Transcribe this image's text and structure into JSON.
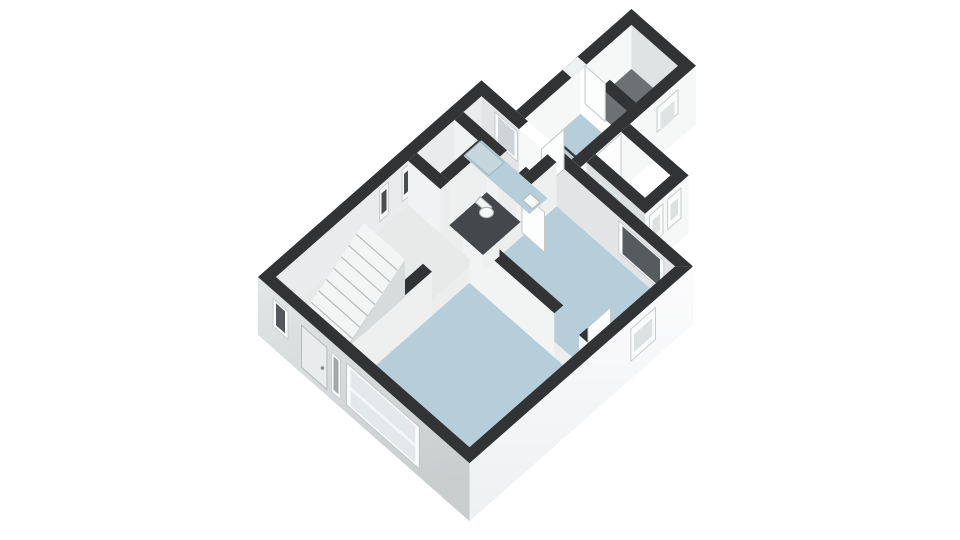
{
  "scene": {
    "description": "3D isometric cutaway floor plan of a dwelling on a white background",
    "view": "isometric-top",
    "background": "#ffffff",
    "width": 960,
    "height": 540
  },
  "palette": {
    "wall_top_band": "#313335",
    "wall_exterior_white": "#f6f7f7",
    "wall_exterior_gray_top": "#e3e6e7",
    "wall_exterior_gray_bottom": "#c9cdce",
    "wall_interior_light": "#f6f7f7",
    "wall_interior_shaded": "#e2e4e5",
    "floor_blue": "#b5ced9",
    "floor_light": "#e8eaea",
    "floor_storage_gray": "#6e7173",
    "floor_wc_dark": "#44484a",
    "glass_dark": "#565b5d",
    "glass_light": "#dde1e2",
    "fixture_white": "#f6f7f7"
  },
  "rooms": [
    {
      "id": "hall",
      "label": "hall with staircase",
      "floor": "light",
      "features": [
        "staircase-8-treads",
        "front-door",
        "two-narrow-nw-windows",
        "corner-window"
      ]
    },
    {
      "id": "living-room",
      "label": "living room",
      "floor": "blue",
      "features": [
        "large-front-window"
      ]
    },
    {
      "id": "bedroom",
      "label": "bedroom",
      "floor": "blue",
      "features": [
        "ne-window",
        "se-window",
        "open-door"
      ]
    },
    {
      "id": "wc",
      "label": "wc",
      "floor": "dark",
      "features": [
        "toilet"
      ]
    },
    {
      "id": "bathroom",
      "label": "bathroom",
      "floor": "blue",
      "features": [
        "shower-tray",
        "washbasin",
        "window",
        "door-to-kitchen"
      ]
    },
    {
      "id": "kitchen",
      "label": "kitchen / rear room",
      "floor": "blue",
      "features": [
        "skylight-outline",
        "side-door"
      ]
    },
    {
      "id": "storage",
      "label": "storage room",
      "floor": "gray",
      "features": [
        "se-window",
        "nw-window-notch",
        "door-to-kitchen"
      ]
    },
    {
      "id": "annex",
      "label": "side annex / porch",
      "floor": "light",
      "features": [
        "two-se-windows",
        "glass-panel"
      ]
    }
  ],
  "shapes": [
    {
      "n": "ext-nw-wall-band",
      "f": "#313335",
      "p": "516,110.7 631.5,9 640.5,17 525,118.6"
    },
    {
      "n": "storage-nw-window-notch",
      "f": "#eef1f1",
      "p": "562.5,69.8 577.5,56.6 586.5,64.5 571.5,77.7"
    },
    {
      "n": "storage-nw-inner-wall",
      "f": "#f6f7f7",
      "p": "589.5,61.8 631.5,24.9 631.5,68.9 589.5,105.8"
    },
    {
      "n": "storage-ne-inner-wall",
      "f": "#e0e3e4",
      "p": "631.5,24.9 678,65.8 678,109.8 631.5,68.9"
    },
    {
      "n": "storage-floor",
      "f": "#6e7173",
      "p": "589.5,105.8 631.5,68.9 678,109.8 636,146.8"
    },
    {
      "n": "kitchen-nw-inner-wall",
      "f": "#f6f7f7",
      "p": "525,118.6 580.5,69.8 580.5,113.8 525,162.6"
    },
    {
      "n": "kitchen-floor",
      "f": "#b5ced9",
      "p": "525,162.6 580.5,113.8 627,154.7 571.5,203.5"
    },
    {
      "n": "kitchen-skylight-outline",
      "f": "none",
      "s": "#3b3d3e",
      "w": 2.5,
      "p": "529.5,163.9 556.5,140.2 585,165.2 558,189"
    },
    {
      "n": "kitchen-storage-partition-band",
      "f": "#313335",
      "p": "600.8,87.6 627,110.7 636,102.8 609.8,79.7"
    },
    {
      "n": "storage-door-leaf",
      "f": "#fcfdfd",
      "s": "#c5c9ca",
      "w": 1,
      "p": "585,65.8 605.3,83.6 605.3,121.6 585,103.8"
    },
    {
      "n": "ext-ne-wall-band",
      "f": "#313335",
      "p": "631.5,9 696,65.8 687,73.7 622.5,17"
    },
    {
      "n": "ext-se-wall-band",
      "f": "#313335",
      "p": "580.5,167.4 696,65.8 678,65.8 571.5,159.5"
    },
    {
      "n": "ext-se-wall-face",
      "f": "#f6f7f7",
      "p": "580.5,167.4 696,65.8 696,123.8 580.5,225.4"
    },
    {
      "n": "storage-se-window-frame",
      "f": "#fafbfb",
      "s": "#c9cdce",
      "w": 1,
      "p": "657,108.1 678,89.6 678,113.6 657,132.1"
    },
    {
      "n": "storage-se-window-glass",
      "f": "#dfe3e4",
      "p": "660.5,112.9 674.5,100.6 674.5,118.1 660.5,130.4"
    },
    {
      "n": "kitchen-se-door",
      "f": "#fdfdfd",
      "s": "#c5c9ca",
      "w": 1,
      "p": "595.5,156.2 621,133.8 621,177.8 595.5,200.2"
    },
    {
      "n": "annex-floor",
      "f": "#eef0f0",
      "p": "604.5,206.2 630,183.7 670.5,219.4 645,241.8"
    },
    {
      "n": "annex-sw-wall-face",
      "f": "#dcdfe0",
      "p": "586.5,162.2 645,213.6 645,271.6 586.5,220.2"
    },
    {
      "n": "annex-sw-glass-panel",
      "f": "#c8d7dd",
      "s": "#eef1f2",
      "w": 1,
      "p": "600,182 618.8,198.5 618.8,238.5 600,222"
    },
    {
      "n": "annex-se-wall-face",
      "f": "#f6f7f7",
      "p": "645,213.6 688.5,175.4 688.5,233.4 645,271.6"
    },
    {
      "n": "annex-window-1-frame",
      "f": "#fafbfb",
      "s": "#c9cdce",
      "w": 1,
      "p": "649.5,215.7 663,203.8 663,233.8 649.5,245.7"
    },
    {
      "n": "annex-window-1-glass",
      "f": "#dde1e2",
      "p": "652.5,220.4 660,213.8 660,230.3 652.5,236.9"
    },
    {
      "n": "annex-window-2-frame",
      "f": "#fafbfb",
      "s": "#c9cdce",
      "w": 1,
      "p": "667.5,199.8 681,188 681,218 667.5,229.8"
    },
    {
      "n": "annex-window-2-glass",
      "f": "#dde1e2",
      "p": "670.5,204.5 678,197.9 678,214.4 670.5,221"
    },
    {
      "n": "annex-sw-wall-band",
      "f": "#313335",
      "p": "586.5,162.2 645,213.6 654,205.7 595.5,154.2"
    },
    {
      "n": "annex-ne-wall-band",
      "f": "#313335",
      "p": "630,123.9 688.5,175.4 679.5,183.3 621,131.8"
    },
    {
      "n": "annex-se-wall-band",
      "f": "#313335",
      "p": "645,213.6 688.5,175.4 679.5,167.4 636,205.7"
    },
    {
      "n": "main-ne-exterior-mask",
      "f": "#ffffff",
      "p": "481.5,80.3 693,266.4 693,324.4 481.5,138.3"
    },
    {
      "n": "main-nw-wall-band",
      "f": "#313335",
      "p": "258,277 481.5,80.3 481.5,96.2 276,277"
    },
    {
      "n": "main-ne-wall-band-a",
      "f": "#313335",
      "p": "481.5,80.3 528,121.2 519,129.2 481.5,96.2"
    },
    {
      "n": "main-ne-wall-band-b",
      "f": "#313335",
      "p": "550.5,141 693,266.4 675,266.4 541.5,149"
    },
    {
      "n": "interior-base-floor",
      "f": "#eceeee",
      "p": "276,321 481.5,140.2 675,310.4 469.5,491.3"
    },
    {
      "n": "main-nw-inner-wall",
      "f": "#e9ebec",
      "p": "276,277 481.5,96.2 481.5,140.2 276,321"
    },
    {
      "n": "nw-slit-window-1-frame",
      "f": "#f5f6f6",
      "s": "#c9cdce",
      "w": 1,
      "p": "379.5,189.9 388.5,182 388.5,214 379.5,221.9"
    },
    {
      "n": "nw-slit-window-1-glass",
      "f": "#4a4d4f",
      "p": "381.5,193.4 386.5,189 386.5,210 381.5,214.4"
    },
    {
      "n": "nw-slit-window-2-frame",
      "f": "#f5f6f6",
      "s": "#c9cdce",
      "w": 1,
      "p": "402,170.1 411,162.2 411,194.2 402,202.1"
    },
    {
      "n": "nw-slit-window-2-glass",
      "f": "#4a4d4f",
      "p": "404,173.9 409,169.5 409,190.5 404,194.9"
    },
    {
      "n": "main-ne-inner-wall",
      "f": "#e2e4e5",
      "p": "481.5,96.2 675,266.4 675,310.4 481.5,140.2"
    },
    {
      "n": "bathroom-window-frame",
      "f": "#fafbfb",
      "s": "#c9cdce",
      "w": 1,
      "p": "495,112 517.5,131.8 517.5,161.8 495,142"
    },
    {
      "n": "bathroom-window-glass",
      "f": "#cfd5d7",
      "p": "498,116.9 514.5,131.4 514.5,156.4 498,141.9"
    },
    {
      "n": "kitchen-doorway-opening",
      "f": "#f7f9f9",
      "p": "519,129.2 541.5,149 541.5,193 519,173.2"
    },
    {
      "n": "kitchen-door-leaf",
      "f": "#fcfdfd",
      "s": "#c5c9ca",
      "w": 1,
      "p": "541.5,149 564,129.2 564,169.2 541.5,189"
    },
    {
      "n": "bedroom-ne-window-frame",
      "f": "#fafbfb",
      "s": "#c9cdce",
      "w": 1,
      "p": "618.8,220.9 663.8,260.5 663.8,292.5 618.8,252.9"
    },
    {
      "n": "bedroom-ne-window-glass",
      "f": "#565b5d",
      "p": "622.5,226.3 660,259.3 660,286.9 622.5,253.9"
    },
    {
      "n": "hall-floor",
      "f": "#e8eaea",
      "p": "276,321 408,204.8 474,262.9 342,379.1"
    },
    {
      "n": "living-room-floor",
      "f": "#b5ced9",
      "p": "351,387 469.5,282.7 588,387 469.5,491.3"
    },
    {
      "n": "bedroom-floor",
      "f": "#b5ced9",
      "p": "478.5,274.8 556.5,206.2 675,310.4 597,379.1"
    },
    {
      "n": "hall-living-wall-band",
      "f": "#313335",
      "p": "342,335.1 423,263.8 432,271.7 351,343"
    },
    {
      "n": "hall-living-wall-face",
      "f": "#eef0f0",
      "p": "351,343 432,271.7 432,315.7 351,387"
    },
    {
      "n": "living-bedroom-wall-band-a",
      "f": "#313335",
      "p": "469.5,238.7 554.3,313.3 563.3,305.4 478.5,230.8"
    },
    {
      "n": "living-bedroom-wall-band-b",
      "f": "#313335",
      "p": "579,335.1 588,343 597,335.1 588,327.2"
    },
    {
      "n": "living-bedroom-wall-face-a",
      "f": "#f2f3f3",
      "p": "469.5,238.7 554.3,313.3 554.3,357.3 469.5,282.7"
    },
    {
      "n": "living-bedroom-wall-face-b",
      "f": "#f2f3f3",
      "p": "579,335.1 588,343 588,387 579,379.1"
    },
    {
      "n": "bedroom-door-leaf",
      "f": "#fcfdfd",
      "s": "#c5c9ca",
      "w": 1,
      "p": "588,327.2 610.5,307.4 610.5,347.4 588,367.2"
    },
    {
      "n": "hall-backrooms-wall-band-a",
      "f": "#313335",
      "p": "408,160.8 440.3,189.2 449.3,181.3 417,152.9"
    },
    {
      "n": "hall-backrooms-wall-band-b",
      "f": "#313335",
      "p": "462.8,209 474,218.9 483,211 471.8,201.1"
    },
    {
      "n": "hall-backrooms-wall-face-a",
      "f": "#f1f2f3",
      "p": "408,160.8 440.3,189.2 440.3,233.2 408,204.8"
    },
    {
      "n": "hall-backrooms-wall-face-b",
      "f": "#f1f2f3",
      "p": "462.8,209 474,218.9 474,262.9 462.8,253"
    },
    {
      "n": "wc-bathroom-wall-band-a",
      "f": "#313335",
      "p": "454.5,119.9 498,158.2 507,150.3 463.5,112"
    },
    {
      "n": "wc-bathroom-wall-band-b",
      "f": "#313335",
      "p": "516.8,174.7 520.5,178 529.5,170.1 525.8,166.8"
    },
    {
      "n": "wc-bathroom-wall-face-a",
      "f": "#f1f2f3",
      "p": "454.5,119.9 498,158.2 498,202.2 454.5,163.9"
    },
    {
      "n": "wc-bathroom-wall-face-b",
      "f": "#f1f2f3",
      "p": "516.8,174.7 520.5,178 520.5,222 516.8,218.7"
    },
    {
      "n": "wc-nw-wall-band",
      "f": "#313335",
      "p": "440.3,173.4 477.8,140.4 486.8,148.3 449.3,181.3"
    },
    {
      "n": "wc-nw-wall-face",
      "f": "#eef0f0",
      "p": "449.3,181.3 486.8,148.3 486.8,192.3 449.3,225.3"
    },
    {
      "n": "corridor-bedroom-wall-band-a",
      "f": "#313335",
      "p": "474,218.9 490.5,204.4 499.5,212.3 483,226.8"
    },
    {
      "n": "corridor-bedroom-wall-band-b",
      "f": "#313335",
      "p": "513,184.6 547.5,154.3 556.5,162.2 522,192.5"
    },
    {
      "n": "corridor-bedroom-wall-face-a",
      "f": "#eef0f0",
      "p": "483,226.8 499.5,212.3 499.5,256.3 483,270.8"
    },
    {
      "n": "corridor-bedroom-wall-face-b",
      "f": "#eef0f0",
      "p": "522,192.5 556.5,162.2 556.5,206.2 522,236.5"
    },
    {
      "n": "corridor-door-leaf",
      "f": "#fcfdfd",
      "s": "#c5c9ca",
      "w": 1,
      "p": "522,192.5 544.5,212.3 544.5,252.3 522,232.5"
    },
    {
      "n": "wc-floor",
      "f": "#44484a",
      "p": "449.3,225.3 486.8,192.3 520.5,222 483,255"
    },
    {
      "n": "toilet-tank",
      "f": "#f4f5f5",
      "s": "#a8adae",
      "w": 1,
      "p": "480,196.5 492,207 487.5,213 475.5,202.5"
    },
    {
      "n": "toilet-bowl",
      "t": "ellipse",
      "f": "#f7f8f8",
      "s": "#a8adae",
      "w": 1,
      "cx": 486.5,
      "cy": 212.5,
      "rx": 7,
      "ry": 5.2
    },
    {
      "n": "bathroom-floor",
      "f": "#b5ced9",
      "p": "463.5,156 481.5,140.2 547.5,198.3 529.5,214.1"
    },
    {
      "n": "shower-tray",
      "f": "#c5d6dd",
      "s": "#9fb3bb",
      "w": 1,
      "p": "465,154.7 480,141.5 504,162.6 489,175.8"
    },
    {
      "n": "washbasin",
      "f": "#f6f7f7",
      "s": "#b5babb",
      "w": 1,
      "p": "522.8,200.2 530.3,193.6 540,202.2 532.5,208.8"
    },
    {
      "n": "staircase-ramp",
      "f": "#f3f4f4",
      "p": "303.8,313.7 345,350 405,259.2 363.8,222.9"
    },
    {
      "n": "staircase-stringer",
      "f": "#d8dbdc",
      "p": "345,350 405,259.2 405,297.2"
    },
    {
      "n": "stair-tread-1",
      "t": "polyline",
      "f": "none",
      "s": "#b9bdbe",
      "w": 1.2,
      "p": "311.3,302.4 352.5,338.7"
    },
    {
      "n": "stair-tread-2",
      "t": "polyline",
      "f": "none",
      "s": "#b9bdbe",
      "w": 1.2,
      "p": "318.8,291.0 360,327.3"
    },
    {
      "n": "stair-tread-3",
      "t": "polyline",
      "f": "none",
      "s": "#b9bdbe",
      "w": 1.2,
      "p": "326.3,279.6 367.5,316.0"
    },
    {
      "n": "stair-tread-4",
      "t": "polyline",
      "f": "none",
      "s": "#b9bdbe",
      "w": 1.2,
      "p": "333.8,268.3 375,304.6"
    },
    {
      "n": "stair-tread-5",
      "t": "polyline",
      "f": "none",
      "s": "#b9bdbe",
      "w": 1.2,
      "p": "341.3,256.9 382.5,293.2"
    },
    {
      "n": "stair-tread-6",
      "t": "polyline",
      "f": "none",
      "s": "#b9bdbe",
      "w": 1.2,
      "p": "348.8,245.6 390,281.9"
    },
    {
      "n": "stair-tread-7",
      "t": "polyline",
      "f": "none",
      "s": "#b9bdbe",
      "w": 1.2,
      "p": "356.3,234.2 397.5,270.5"
    },
    {
      "n": "main-sw-wall-face",
      "f": "url(#gswall)",
      "p": "258,277 469.5,463.1 469.5,521.1 258,335"
    },
    {
      "n": "main-se-wall-face",
      "f": "url(#gsewall)",
      "p": "469.5,463.1 693,266.4 693,324.4 469.5,521.1"
    },
    {
      "n": "main-sw-wall-band",
      "f": "#313335",
      "p": "469.5,463.1 258,277 276,277 469.5,447.3"
    },
    {
      "n": "main-se-wall-band",
      "f": "#313335",
      "p": "693,266.4 469.5,463.1 469.5,447.3 675,266.4"
    },
    {
      "n": "front-door",
      "f": "#e9ebec",
      "s": "#b5babb",
      "w": 1,
      "p": "301.5,325.3 327,347.7 327,389.7 301.5,367.3"
    },
    {
      "n": "front-door-handle",
      "t": "ellipse",
      "f": "#84898b",
      "cx": 322.5,
      "cy": 368,
      "rx": 1.8,
      "ry": 1.8
    },
    {
      "n": "corner-window-frame",
      "f": "#fafbfb",
      "s": "#c9cdce",
      "w": 1,
      "p": "273,298.2 288,311.4 288,339.4 273,326.2"
    },
    {
      "n": "corner-window-glass",
      "f": "#54585a",
      "p": "276,303.3 285,311.2 285,333.3 276,325.4"
    },
    {
      "n": "door-sidelight-frame",
      "f": "#fafbfb",
      "s": "#c9cdce",
      "w": 1,
      "p": "331.5,351.7 340.5,359.6 340.5,399.6 331.5,391.7"
    },
    {
      "n": "door-sidelight-glass",
      "f": "#a3a8aa",
      "p": "333.5,356.3 338.5,360.7 338.5,394.3 333.5,389.9"
    },
    {
      "n": "living-window-frame",
      "f": "#fafbfb",
      "s": "#c2c6c7",
      "w": 1,
      "p": "346.5,362.9 419.3,426.9 419.3,468.9 346.5,404.9"
    },
    {
      "n": "living-window-glass",
      "f": "#e3e8ea",
      "p": "350.5,369.2 415.3,426.2 415.3,462.6 350.5,405.6"
    },
    {
      "n": "living-window-rail",
      "f": "#f4f5f5",
      "p": "350.5,386.5 415.3,443.5 415.3,447.5 350.5,390.5"
    },
    {
      "n": "bedroom-se-window-frame",
      "f": "#fafbfb",
      "s": "#c9cdce",
      "w": 1,
      "p": "630.8,329.2 655.5,307.4 655.5,339.4 630.8,361.2"
    },
    {
      "n": "bedroom-se-window-glass",
      "f": "#dde1e2",
      "p": "634,334.3 652.3,318.2 652.3,335.9 634,352"
    }
  ]
}
